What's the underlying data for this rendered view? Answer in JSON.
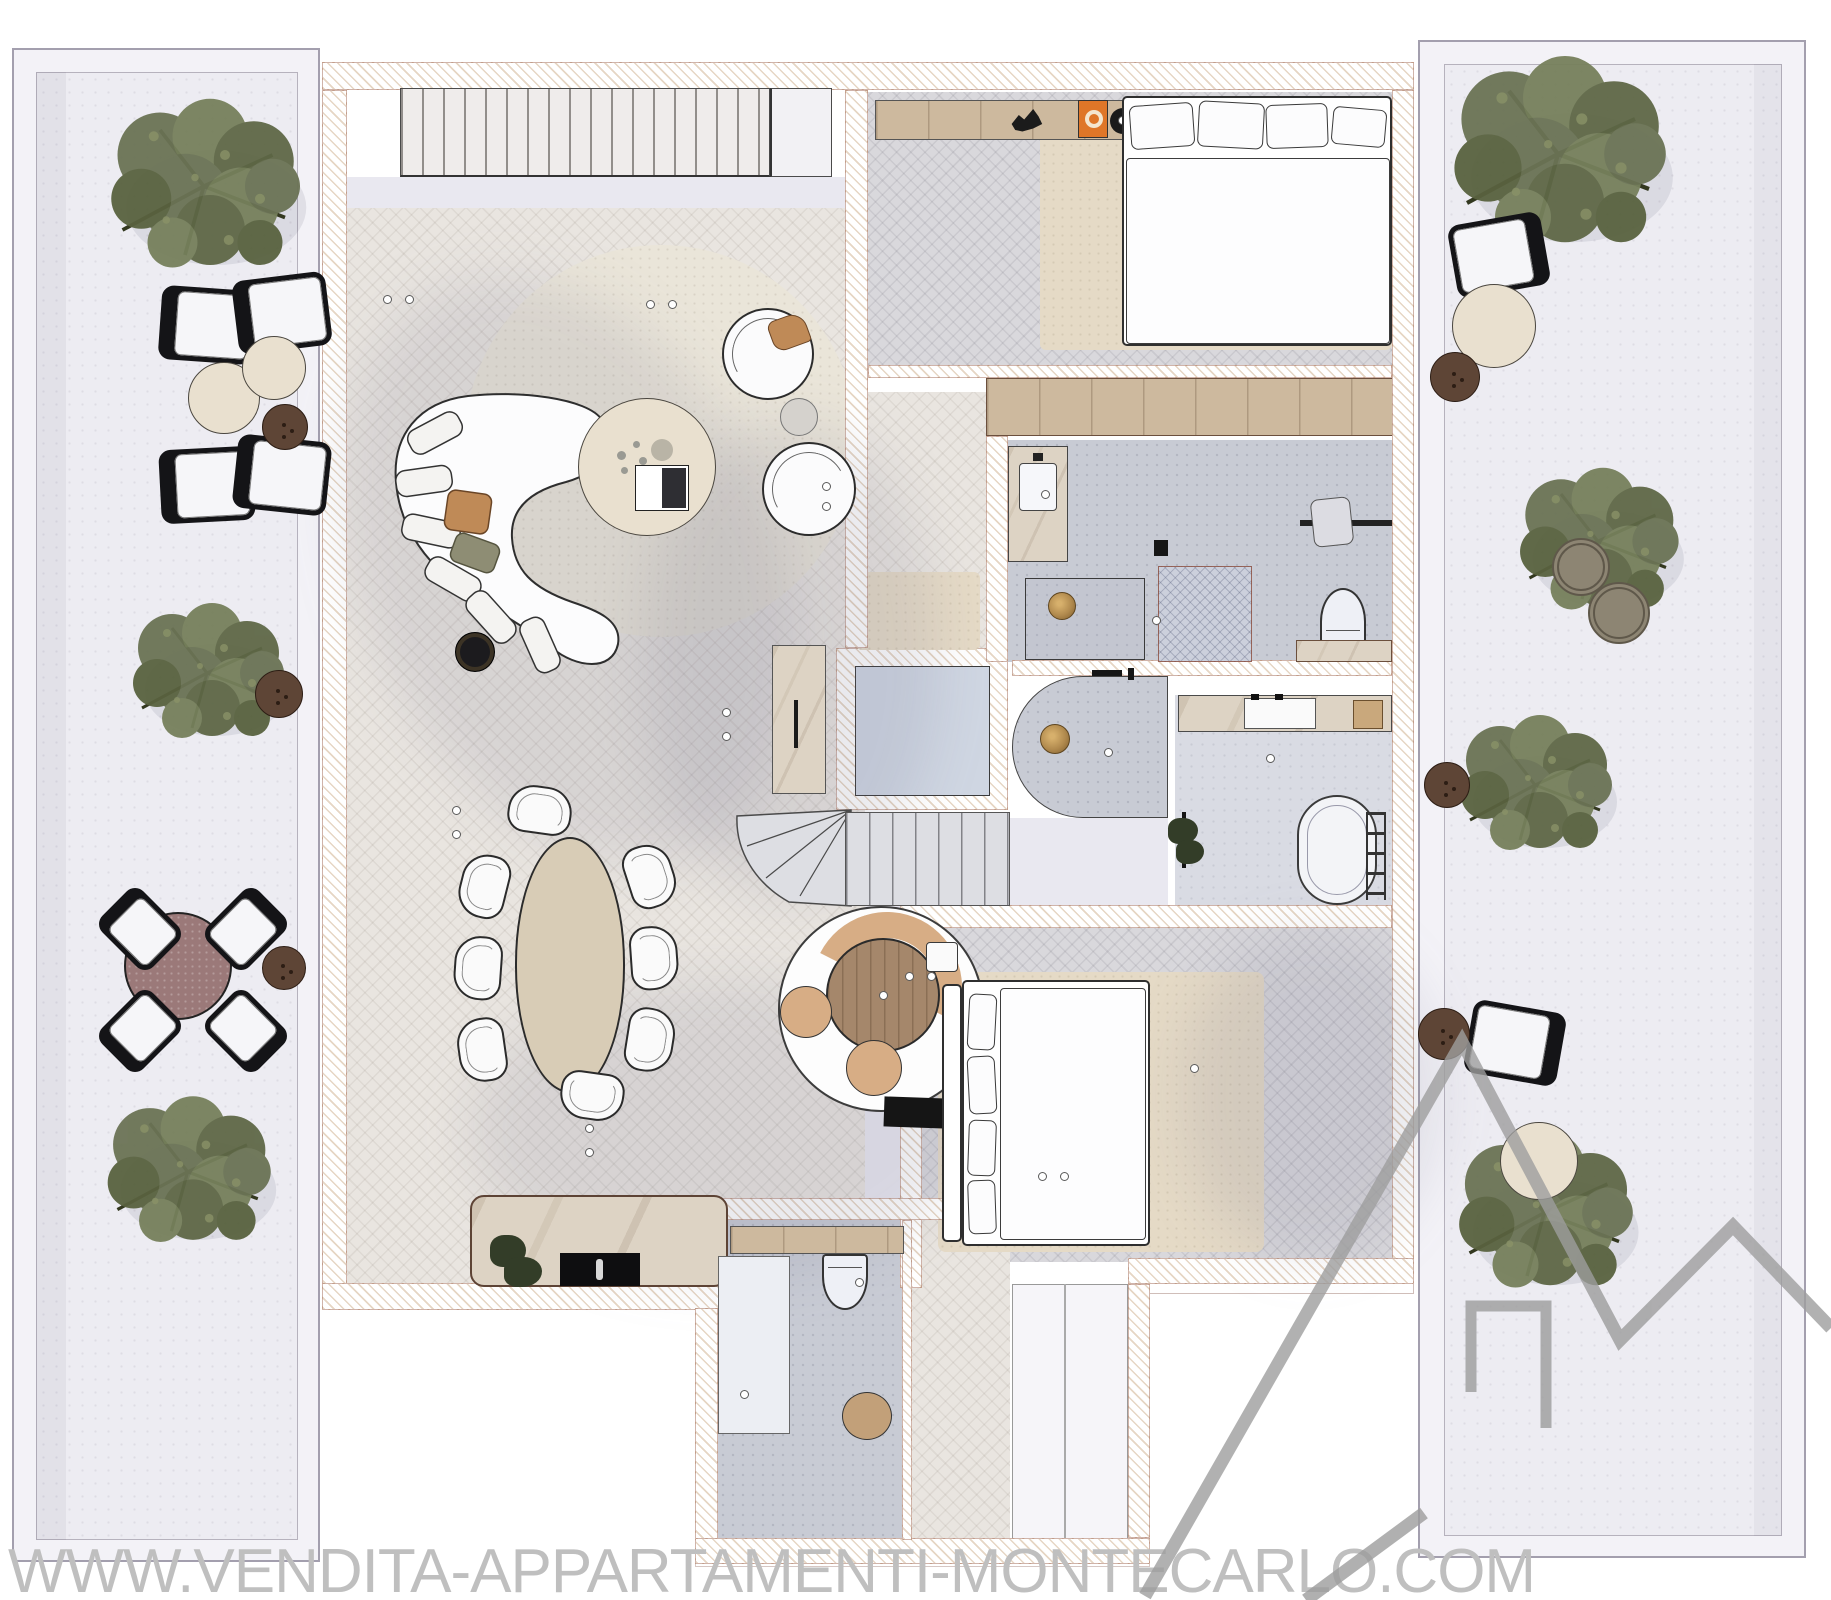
{
  "watermark": {
    "url_text": "WWW.VENDITA-APPARTAMENTI-MONTECARLO.COM",
    "logo_icon": "house-roofline-logo"
  },
  "palette": {
    "paper": "#ffffff",
    "wall_hatch": "#e6d6c4",
    "wood_floor": "#e9e5e0",
    "bedroom_floor": "#d9d8dc",
    "bath_floor": "#c8cbd4",
    "bath_floor_light": "#d9dbe3",
    "terrace_paving": "#edecf2",
    "terrace_frame": "#f3f2f7",
    "lavender": "#e9e8f0",
    "elevator_floor": "#cfd6e2",
    "rug_cream": "#eae5d9",
    "rug_beige": "#e5dac6",
    "marble": "#ddd3c4",
    "wood": "#cdb99e",
    "wood_table": "#a5876b",
    "dining_table_top": "#d8ccb6",
    "tan_seat": "#d7ad85",
    "pouf_brown": "#5e4536",
    "mauve_table": "#9b7979",
    "tree_green": "#6b7355",
    "brass": "#b18a4e",
    "stair_tread": "#dddee3",
    "orange_art": "#df7628",
    "watermark_text": "#bfbfbf",
    "watermark_logo": "#9d9d9d"
  },
  "icons": [
    "olive-tree",
    "lounge-chair",
    "side-table",
    "pouf",
    "outdoor-dining-table",
    "outdoor-chair",
    "planter",
    "curved-sofa",
    "armchair",
    "coffee-table",
    "area-rug",
    "dining-table",
    "dining-chair",
    "kitchen-island",
    "cooktop",
    "straight-staircase",
    "curved-staircase",
    "elevator",
    "double-bed",
    "pillow",
    "wardrobe",
    "vanity-sink",
    "walk-in-shower",
    "steam-room",
    "floor-drain",
    "toilet",
    "bathtub",
    "towel-ladder",
    "breakfast-table",
    "banquette",
    "stool",
    "doormat",
    "plant",
    "ceiling-light",
    "house-logo"
  ]
}
